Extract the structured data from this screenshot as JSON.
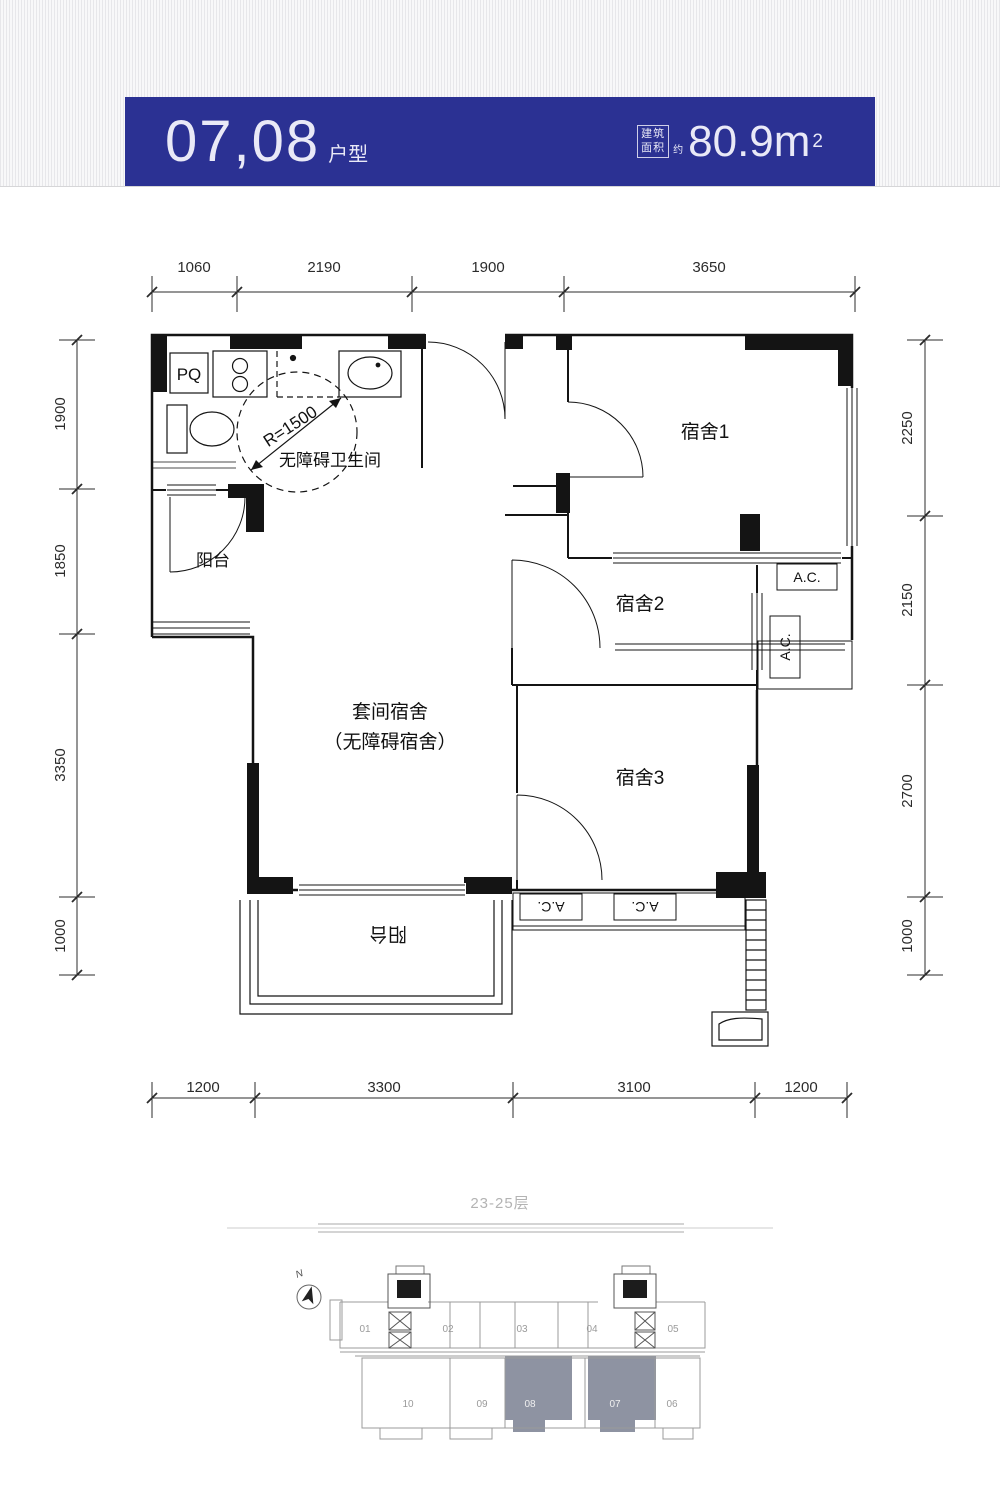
{
  "header": {
    "unit_numbers": "07,08",
    "unit_type_label": "户型",
    "area_label_top": "建筑",
    "area_label_bottom": "面积",
    "area_approx_label": "约",
    "area_value": "80.9m",
    "area_superscript": "2"
  },
  "plan": {
    "labels": {
      "dorm1": "宿舍1",
      "dorm2": "宿舍2",
      "dorm3": "宿舍3",
      "suite_line1": "套间宿舍",
      "suite_line2": "（无障碍宿舍）",
      "bathroom": "无障碍卫生间",
      "balcony_left": "阳台",
      "balcony_bottom": "阳台",
      "radius": "R=1500",
      "kitchen_pq": "PQ",
      "ac": "A.C."
    },
    "dimensions": {
      "top": [
        "1060",
        "2190",
        "1900",
        "3650"
      ],
      "bottom": [
        "1200",
        "3300",
        "3100",
        "1200"
      ],
      "left": [
        "1900",
        "1850",
        "3350",
        "1000"
      ],
      "right": [
        "2250",
        "2150",
        "2700",
        "1000"
      ]
    }
  },
  "site": {
    "floor_range_label": "23-25层",
    "north_label": "N",
    "units_top": [
      "01",
      "02",
      "03",
      "04",
      "05"
    ],
    "units_bottom": [
      "10",
      "09",
      "08",
      "07",
      "06"
    ],
    "highlighted_units": [
      "08",
      "07"
    ],
    "highlight_color": "#8e93a2"
  },
  "colors": {
    "banner_blue": "#2b3193"
  }
}
